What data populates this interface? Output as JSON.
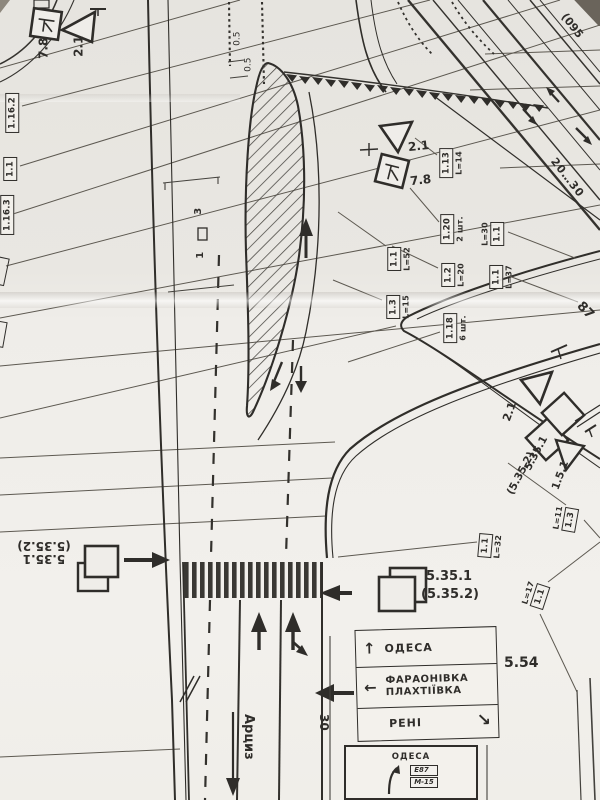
{
  "signs": {
    "top_left": {
      "plate": "7.8",
      "yield": "2.1"
    },
    "top_mid": {
      "yield": "2.1",
      "plate": "7.8"
    },
    "right_group": {
      "yield": "2.1",
      "sq1": "5.35.1",
      "sq2": "(5.35.2)",
      "tri": "1.5.1"
    },
    "crosswalk_sign": {
      "line1": "5.35.1",
      "line2": "(5.35.2)"
    },
    "bottom_left_sign": {
      "line1": "5.35.1",
      "line2": "(5.35.2)"
    },
    "dir_board_code": "5.54"
  },
  "labels": {
    "left": [
      {
        "code": "1.16.2"
      },
      {
        "code": "1.1"
      },
      {
        "code": "1.16.3"
      }
    ],
    "mid": [
      {
        "code": "1.13",
        "note": "L=14"
      },
      {
        "code": "1.20",
        "note": "2 шт."
      },
      {
        "code": "1.1",
        "note": "L=30"
      },
      {
        "code": "1.1",
        "note": "L=52"
      },
      {
        "code": "1.2",
        "note": "L=20"
      },
      {
        "code": "1.1",
        "note": "L=37"
      },
      {
        "code": "1.3",
        "note": "L=15"
      },
      {
        "code": "1.18",
        "note": "6 шт."
      }
    ],
    "right": [
      {
        "code": "1.3",
        "note": "L=11"
      },
      {
        "code": "1.1",
        "note": "L=32"
      },
      {
        "code": "1.1",
        "note": "L=17"
      }
    ]
  },
  "dims": {
    "half_a": "0.5",
    "half_b": "0.5",
    "range": "20…30",
    "code095": "(095",
    "n87": "87",
    "lane3": "3",
    "lane1": "1",
    "n30": "30"
  },
  "places": {
    "down_road": "Арциз"
  },
  "glyphs": {
    "up": "↑",
    "left": "←",
    "down_right": "↘"
  },
  "dir_table": {
    "rows": [
      {
        "line1": "ОДЕСА"
      },
      {
        "line1": "ФАРАОНІВКА",
        "line2": "ПЛАХТІЇВКА"
      },
      {
        "line1": "РЕНІ"
      }
    ]
  },
  "bottom_board": {
    "title": "ОДЕСА",
    "badge1": "Е87",
    "badge2": "М-15"
  }
}
